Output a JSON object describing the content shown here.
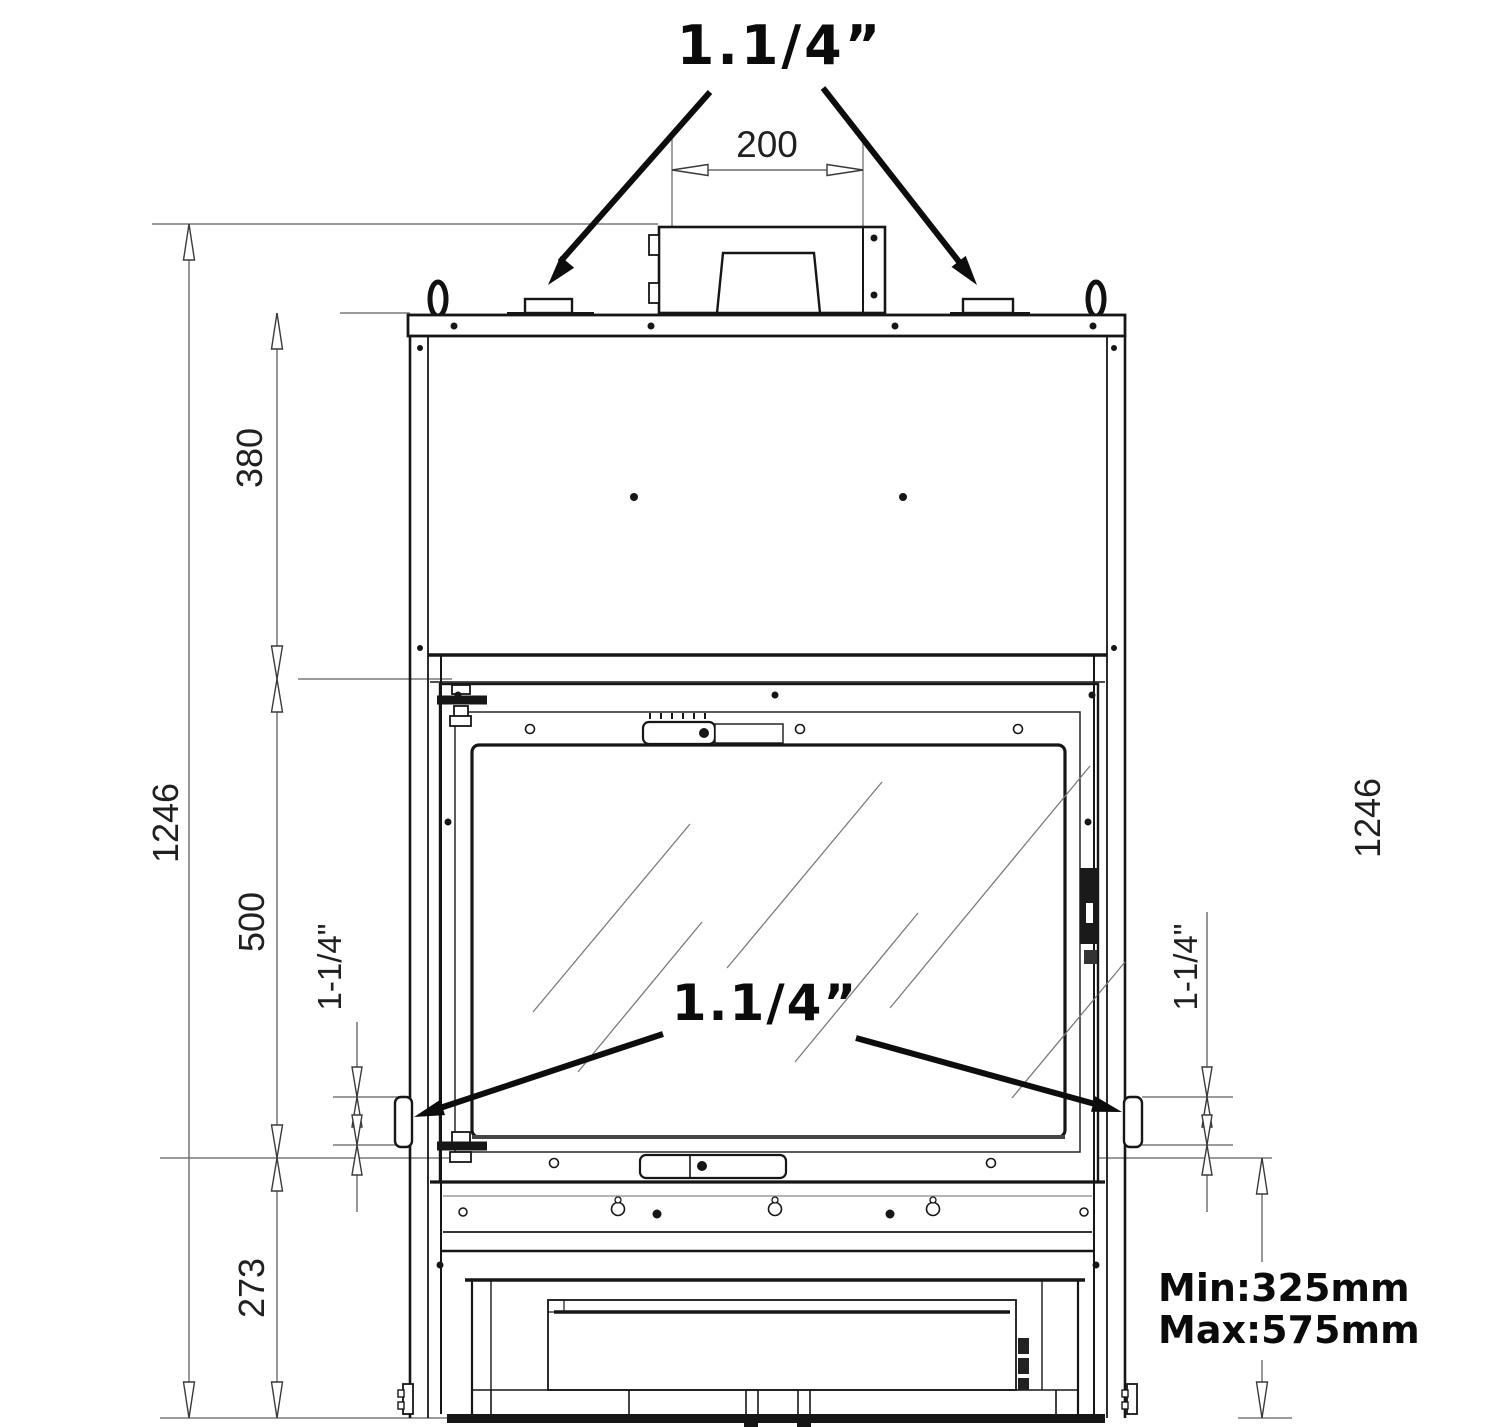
{
  "drawing": {
    "top_connection_label": "1.1/4”",
    "side_connection_label": "1.1/4”",
    "dims": {
      "flue_width": "200",
      "upper_section_height": "380",
      "door_section_height": "500",
      "base_section_height": "273",
      "total_height_left": "1246",
      "total_height_right": "1246",
      "left_pipe_size": "1-1/4\"",
      "right_pipe_size": "1-1/4\"",
      "clearance_min": "Min:325mm",
      "clearance_max": "Max:575mm"
    }
  }
}
